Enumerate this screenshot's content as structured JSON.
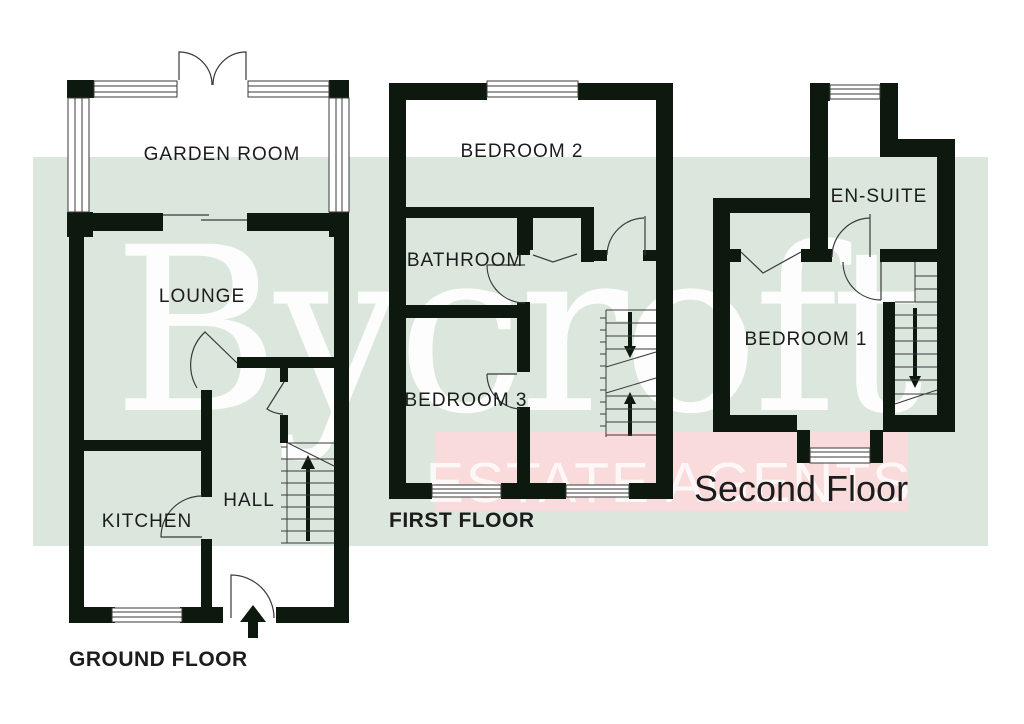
{
  "watermark": {
    "brand": "Bycroft",
    "tagline": "ESTATE AGENTS"
  },
  "colors": {
    "wall": "#0d180e",
    "line": "#3a3a3a",
    "text": "#1c1c1c",
    "band_green": "#dbe7dc",
    "band_pink": "#fadbdb",
    "window_fill": "#ffffff",
    "watermark_white": "#ffffff"
  },
  "floors": {
    "ground": {
      "title": "GROUND FLOOR",
      "rooms": {
        "garden_room": "GARDEN ROOM",
        "lounge": "LOUNGE",
        "kitchen": "KITCHEN",
        "hall": "HALL"
      }
    },
    "first": {
      "title": "FIRST FLOOR",
      "rooms": {
        "bedroom2": "BEDROOM 2",
        "bathroom": "BATHROOM",
        "bedroom3": "BEDROOM 3"
      }
    },
    "second": {
      "title": "Second Floor",
      "rooms": {
        "ensuite": "EN-SUITE",
        "bedroom1": "BEDROOM 1"
      }
    }
  }
}
